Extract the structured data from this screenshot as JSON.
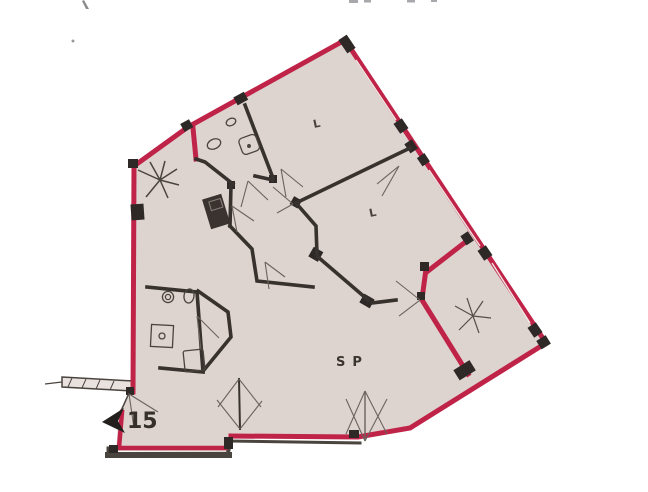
{
  "document": {
    "kind": "scanned apartment floor plan",
    "background_color": "#ffffff"
  },
  "plan": {
    "floor_color": "#ddd3cf",
    "outer_wall_color": "#c02348",
    "inner_wall_color": "#38322e",
    "underlay_color": "#4a443f",
    "thin_line_color": "#6b635d",
    "window_line_color": "#f0e7e3",
    "labels": {
      "bedroom_1": "L",
      "bedroom_2": "L",
      "living_dining": "SP",
      "entrance_number": "15"
    },
    "symbols": {
      "light_point_1": "star-light-symbol",
      "light_point_2": "star-light-symbol",
      "entrance_marker": "entrance-arrow-icon"
    }
  }
}
